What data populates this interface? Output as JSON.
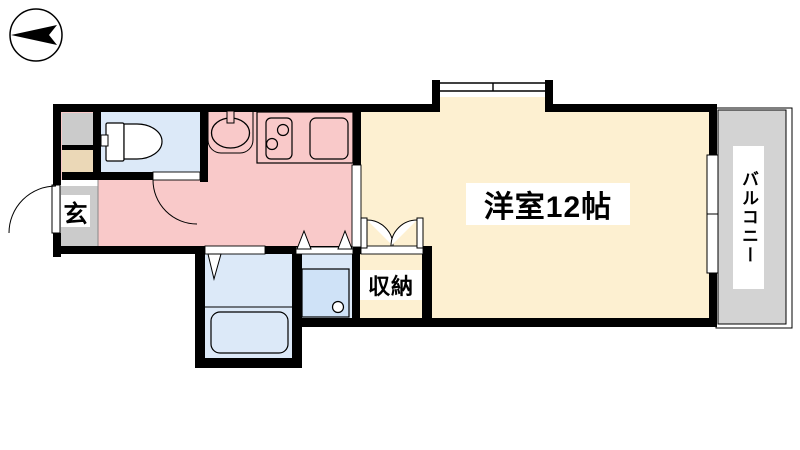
{
  "floorplan": {
    "labels": {
      "entrance": "玄",
      "main_room": "洋室12帖",
      "storage": "収納",
      "balcony": "バルコニー"
    },
    "icons": {
      "compass": "north-arrow-left"
    },
    "colors": {
      "kitchen_area": "#f9c9c9",
      "room_floor": "#fdf0d1",
      "wet_rooms": "#dce9f8",
      "washing_pan": "#cfe2f7",
      "entrance_gray": "#cbcbcb",
      "utility_box_tan": "#ebd8b7",
      "balcony_gray": "#d3d3d3",
      "walls": "#000000"
    }
  }
}
